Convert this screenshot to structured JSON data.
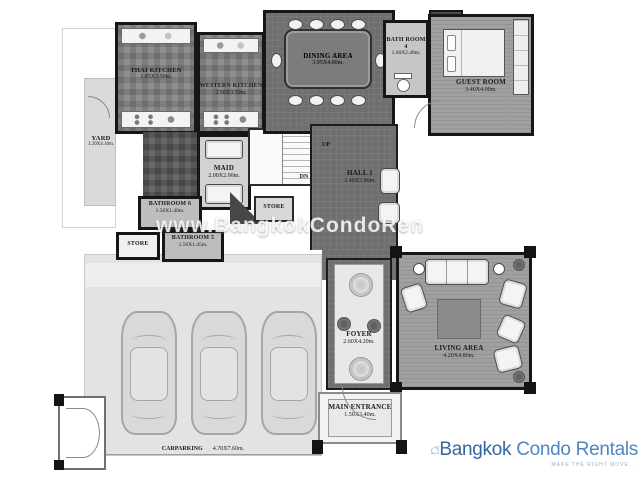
{
  "watermark": "www.BangkokCondoRen",
  "stairs": {
    "up": "UP",
    "dn": "DN"
  },
  "rooms": {
    "thai_kitchen": {
      "name": "THAI KITCHEN",
      "dims": "1.85X3.50m."
    },
    "western_kitchen": {
      "name": "WESTERN KITCHEN",
      "dims": "2.50X3.50m."
    },
    "dining": {
      "name": "DINING AREA",
      "dims": "3.95X4.00m."
    },
    "bath4": {
      "name": "BATH ROOM 4",
      "dims": "1.60X2.40m."
    },
    "guest": {
      "name": "GUEST ROOM",
      "dims": "3.40X4.00m."
    },
    "yard": {
      "name": "YARD",
      "dims": "1.20X4.10m."
    },
    "maid": {
      "name": "MAID",
      "dims": "2.00X2.90m."
    },
    "bathroom6": {
      "name": "BATHROOM 6",
      "dims": "1.50X1.40m."
    },
    "store_left": {
      "name": "STORE"
    },
    "bathroom5": {
      "name": "BATHROOM 5",
      "dims": "1.50X1.45m."
    },
    "store_center": {
      "name": "STORE"
    },
    "hall": {
      "name": "HALL 1",
      "dims": "3.40X2.90m."
    },
    "foyer": {
      "name": "FOYER",
      "dims": "2.60X4.20m."
    },
    "living": {
      "name": "LIVING AREA",
      "dims": "4.20X4.80m."
    },
    "entrance": {
      "name": "MAIN ENTRANCE",
      "dims": "1.50X3.40m."
    },
    "carparking": {
      "name": "CARPARKING",
      "dims": "4.70X7.60m."
    }
  },
  "logo": {
    "brand_dark": "Bangkok",
    "brand_light": " Condo Rentals",
    "tagline": "MAKE THE RIGHT MOVE...",
    "colors": {
      "dark": "#33679f",
      "light": "#4e86c2",
      "icon": "#8fb3d9"
    }
  }
}
